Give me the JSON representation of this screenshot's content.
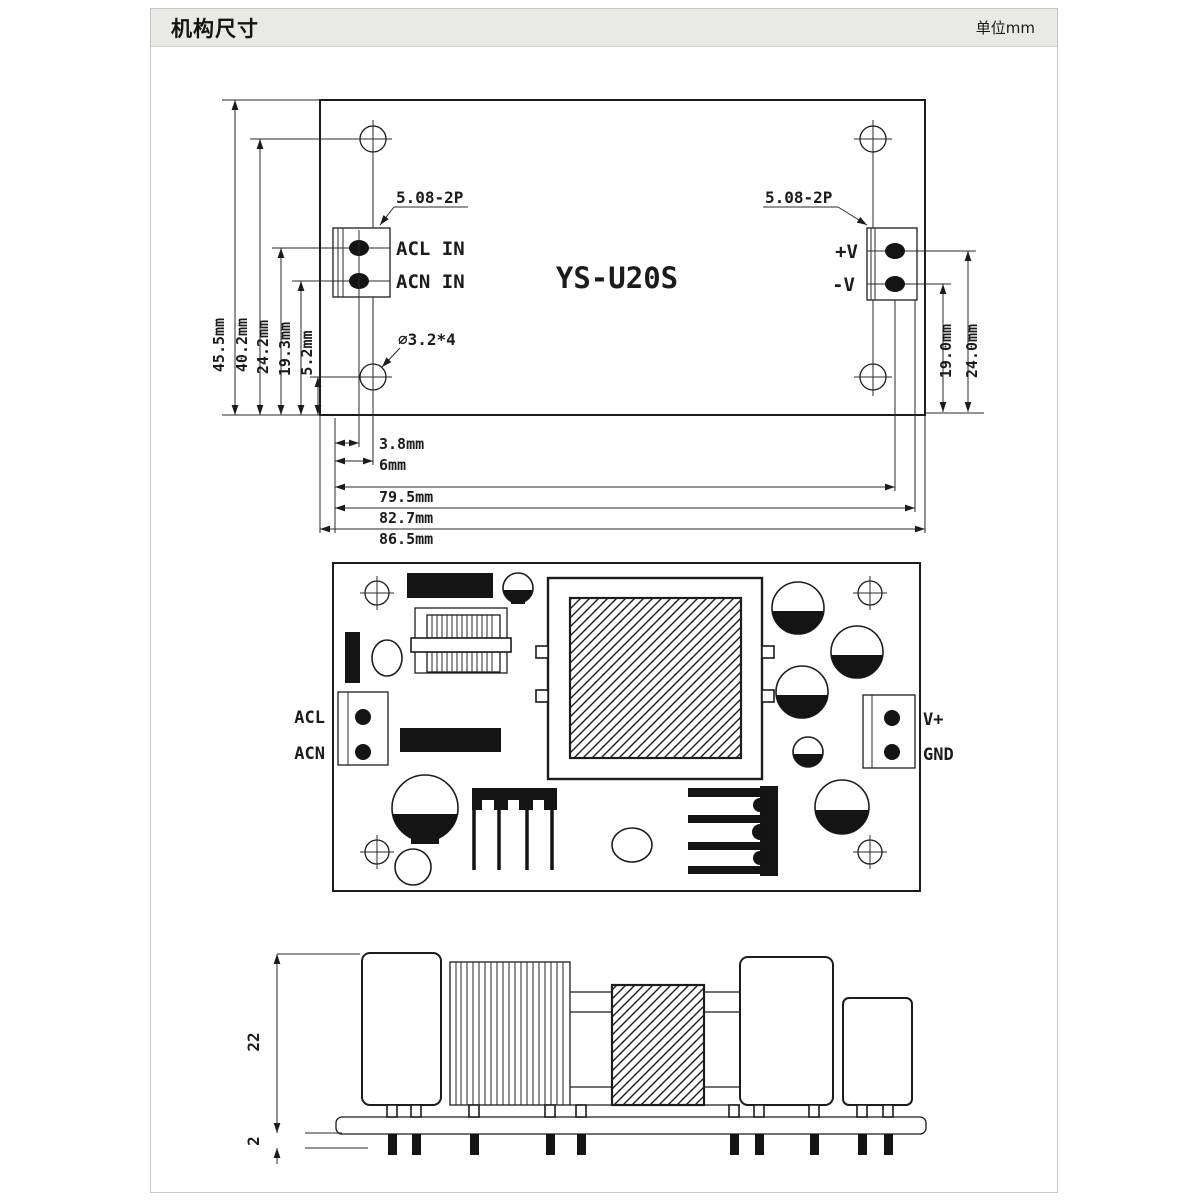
{
  "header": {
    "title": "机构尺寸",
    "unit": "单位mm"
  },
  "top_view": {
    "model": "YS-U20S",
    "left_connector_note": "5.08-2P",
    "right_connector_note": "5.08-2P",
    "hole_note": "⌀3.2*4",
    "pins_left": [
      "ACL IN",
      "ACN IN"
    ],
    "pins_right": [
      "+V",
      "-V"
    ],
    "dims_left": [
      "45.5mm",
      "40.2mm",
      "24.2mm",
      "19.3mm",
      "5.2mm"
    ],
    "dims_right": [
      "19.0mm",
      "24.0mm"
    ],
    "dims_bottom": [
      "3.8mm",
      "6mm",
      "79.5mm",
      "82.7mm",
      "86.5mm"
    ]
  },
  "pcb_view": {
    "pins_left": [
      "ACL",
      "ACN"
    ],
    "pins_right": [
      "V+",
      "GND"
    ]
  },
  "side_view": {
    "dims": [
      "22",
      "2"
    ]
  },
  "colors": {
    "line": "#1c1c1c",
    "header_bg": "#e9e9e6",
    "border": "#c9c9c9"
  }
}
